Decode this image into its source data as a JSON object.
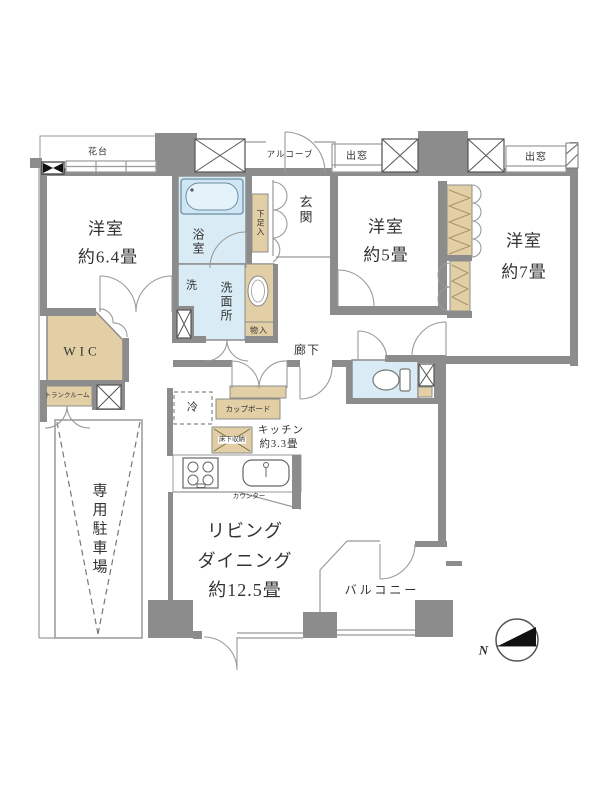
{
  "plan": {
    "type": "floorplan",
    "labels": {
      "hanadai": "花台",
      "alcove": "アルコーブ",
      "bay_left": "出窓",
      "bay_right": "出窓",
      "room64_1": "洋室",
      "room64_2": "約6.4畳",
      "room5_1": "洋室",
      "room5_2": "約5畳",
      "room7_1": "洋室",
      "room7_2": "約7畳",
      "entrance": "玄関",
      "shoe_cabinet": "下足入",
      "bath": "浴室",
      "washer": "洗",
      "washroom": "洗面所",
      "storage_small": "物入",
      "wic": "WIC",
      "hallway": "廊下",
      "fridge": "冷",
      "cupboard": "カップボード",
      "underfloor_storage": "床下収納",
      "kitchen_1": "キッチン",
      "kitchen_2": "約3.3畳",
      "counter": "カウンター",
      "trunk_room": "トランクルーム",
      "parking": "専用駐車場",
      "living_1": "リビング",
      "living_2": "ダイニング",
      "living_3": "約12.5畳",
      "balcony": "バルコニー",
      "north": "N"
    },
    "colors": {
      "wall": "#8c8c8c",
      "wet_area": "#d9ecf6",
      "storage": "#e2cfa5",
      "line": "#999999",
      "text": "#333333"
    }
  }
}
